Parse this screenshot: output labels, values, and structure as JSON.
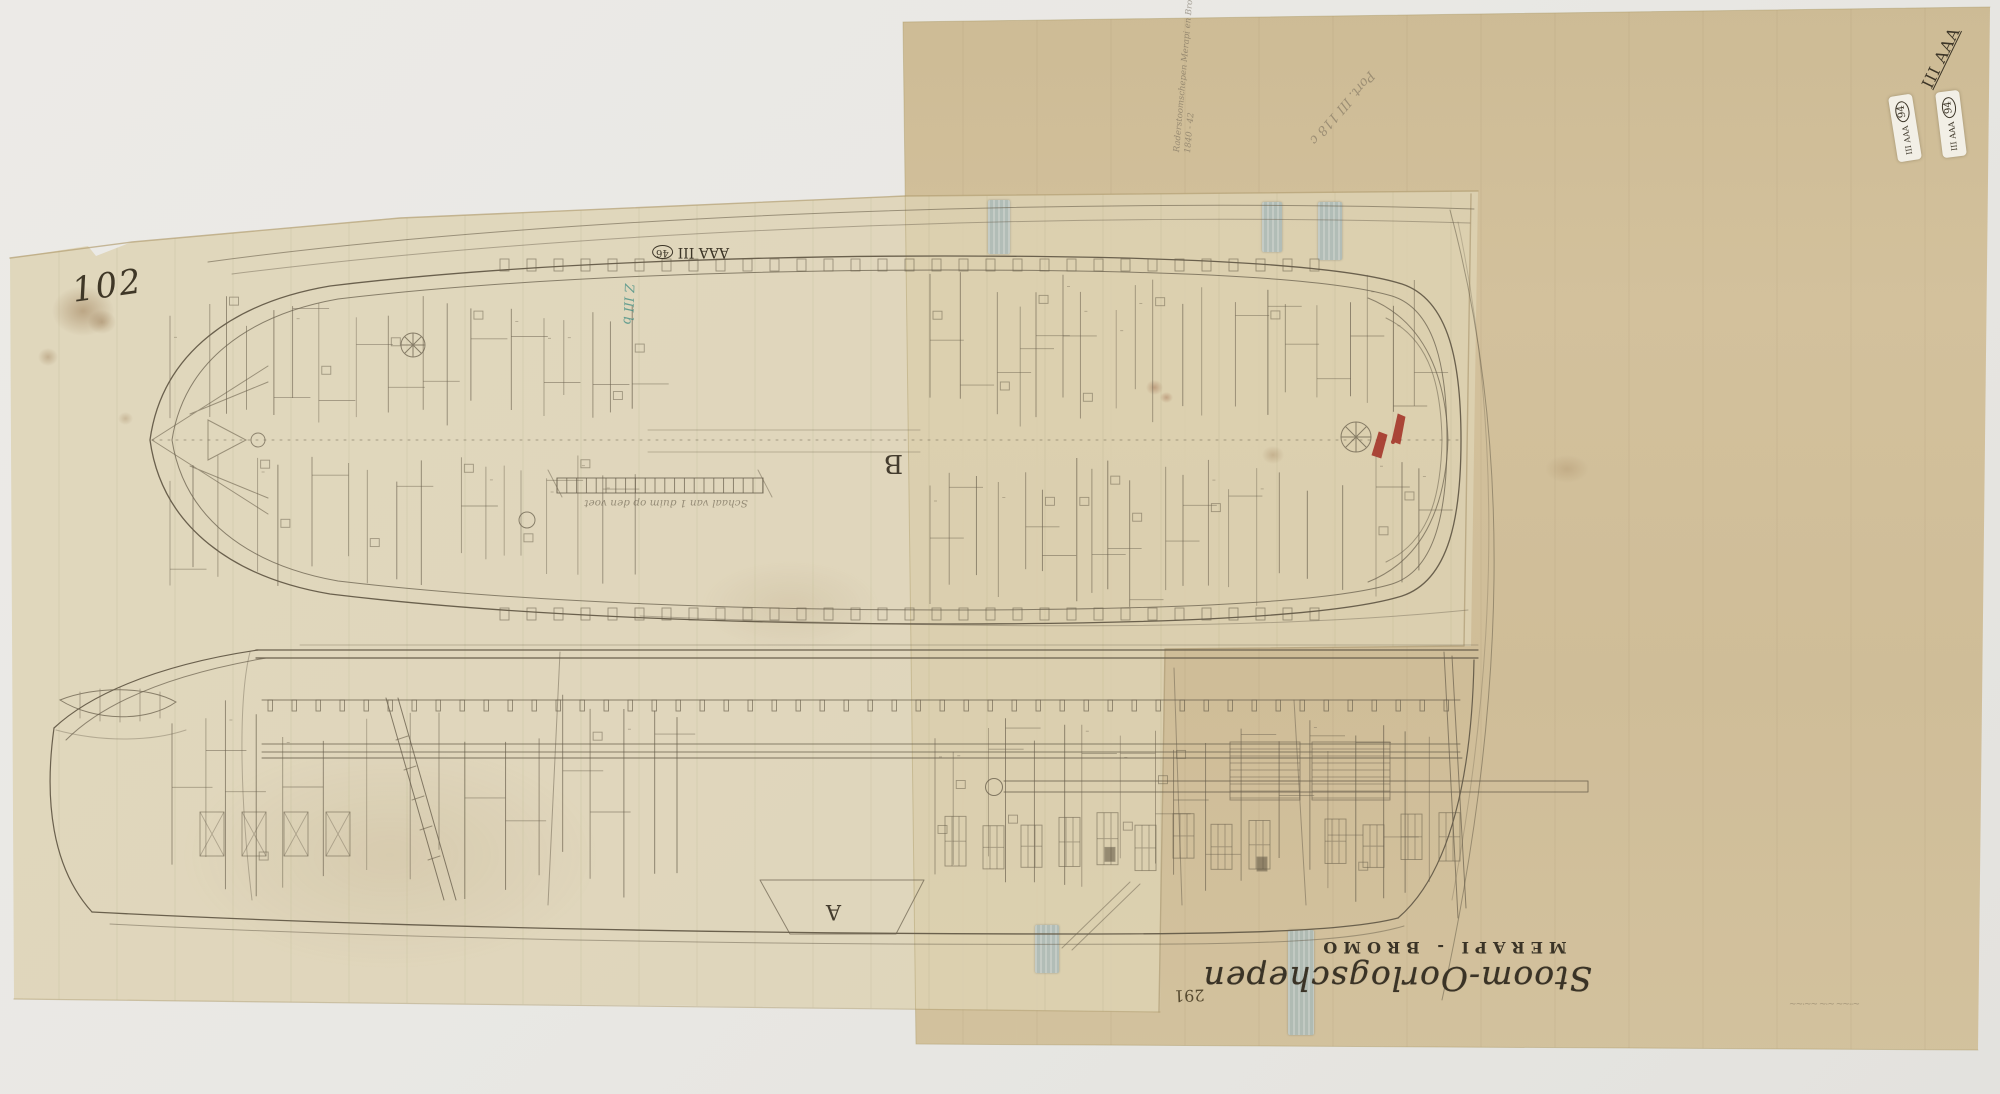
{
  "scene": {
    "background_color": "#e9e8e4"
  },
  "sheets": {
    "backing_color": "#cfbd97",
    "tracing_color": "#e2d6b6"
  },
  "title_block": {
    "main_title": "Stoom-Oorlogschepen",
    "ship_names": "MERAPI - BROMO"
  },
  "annotations": {
    "corner_number": "102",
    "inventory_number": "291",
    "center_archive_mark": {
      "text": "AAA III",
      "circled_number": "46"
    },
    "corner_archive_mark": "III AAA",
    "stickers": [
      {
        "text": "III AAA",
        "circled_number": "94"
      },
      {
        "text": "III AAA",
        "circled_number": "94"
      }
    ],
    "teal_shelfmark": "Z III b",
    "pencil_note_line1": "Raderstoomschepen Merapi en Bromo",
    "pencil_note_line2": "1840 - 42",
    "pencil_portfolio_mark": "Port. III 118 c",
    "deck_plan_letter": "B",
    "profile_letter": "A",
    "scale_caption": "Schaal van 1 duim op den voet",
    "faint_inscription": "~··~~ ~·~ ~~·~~"
  }
}
